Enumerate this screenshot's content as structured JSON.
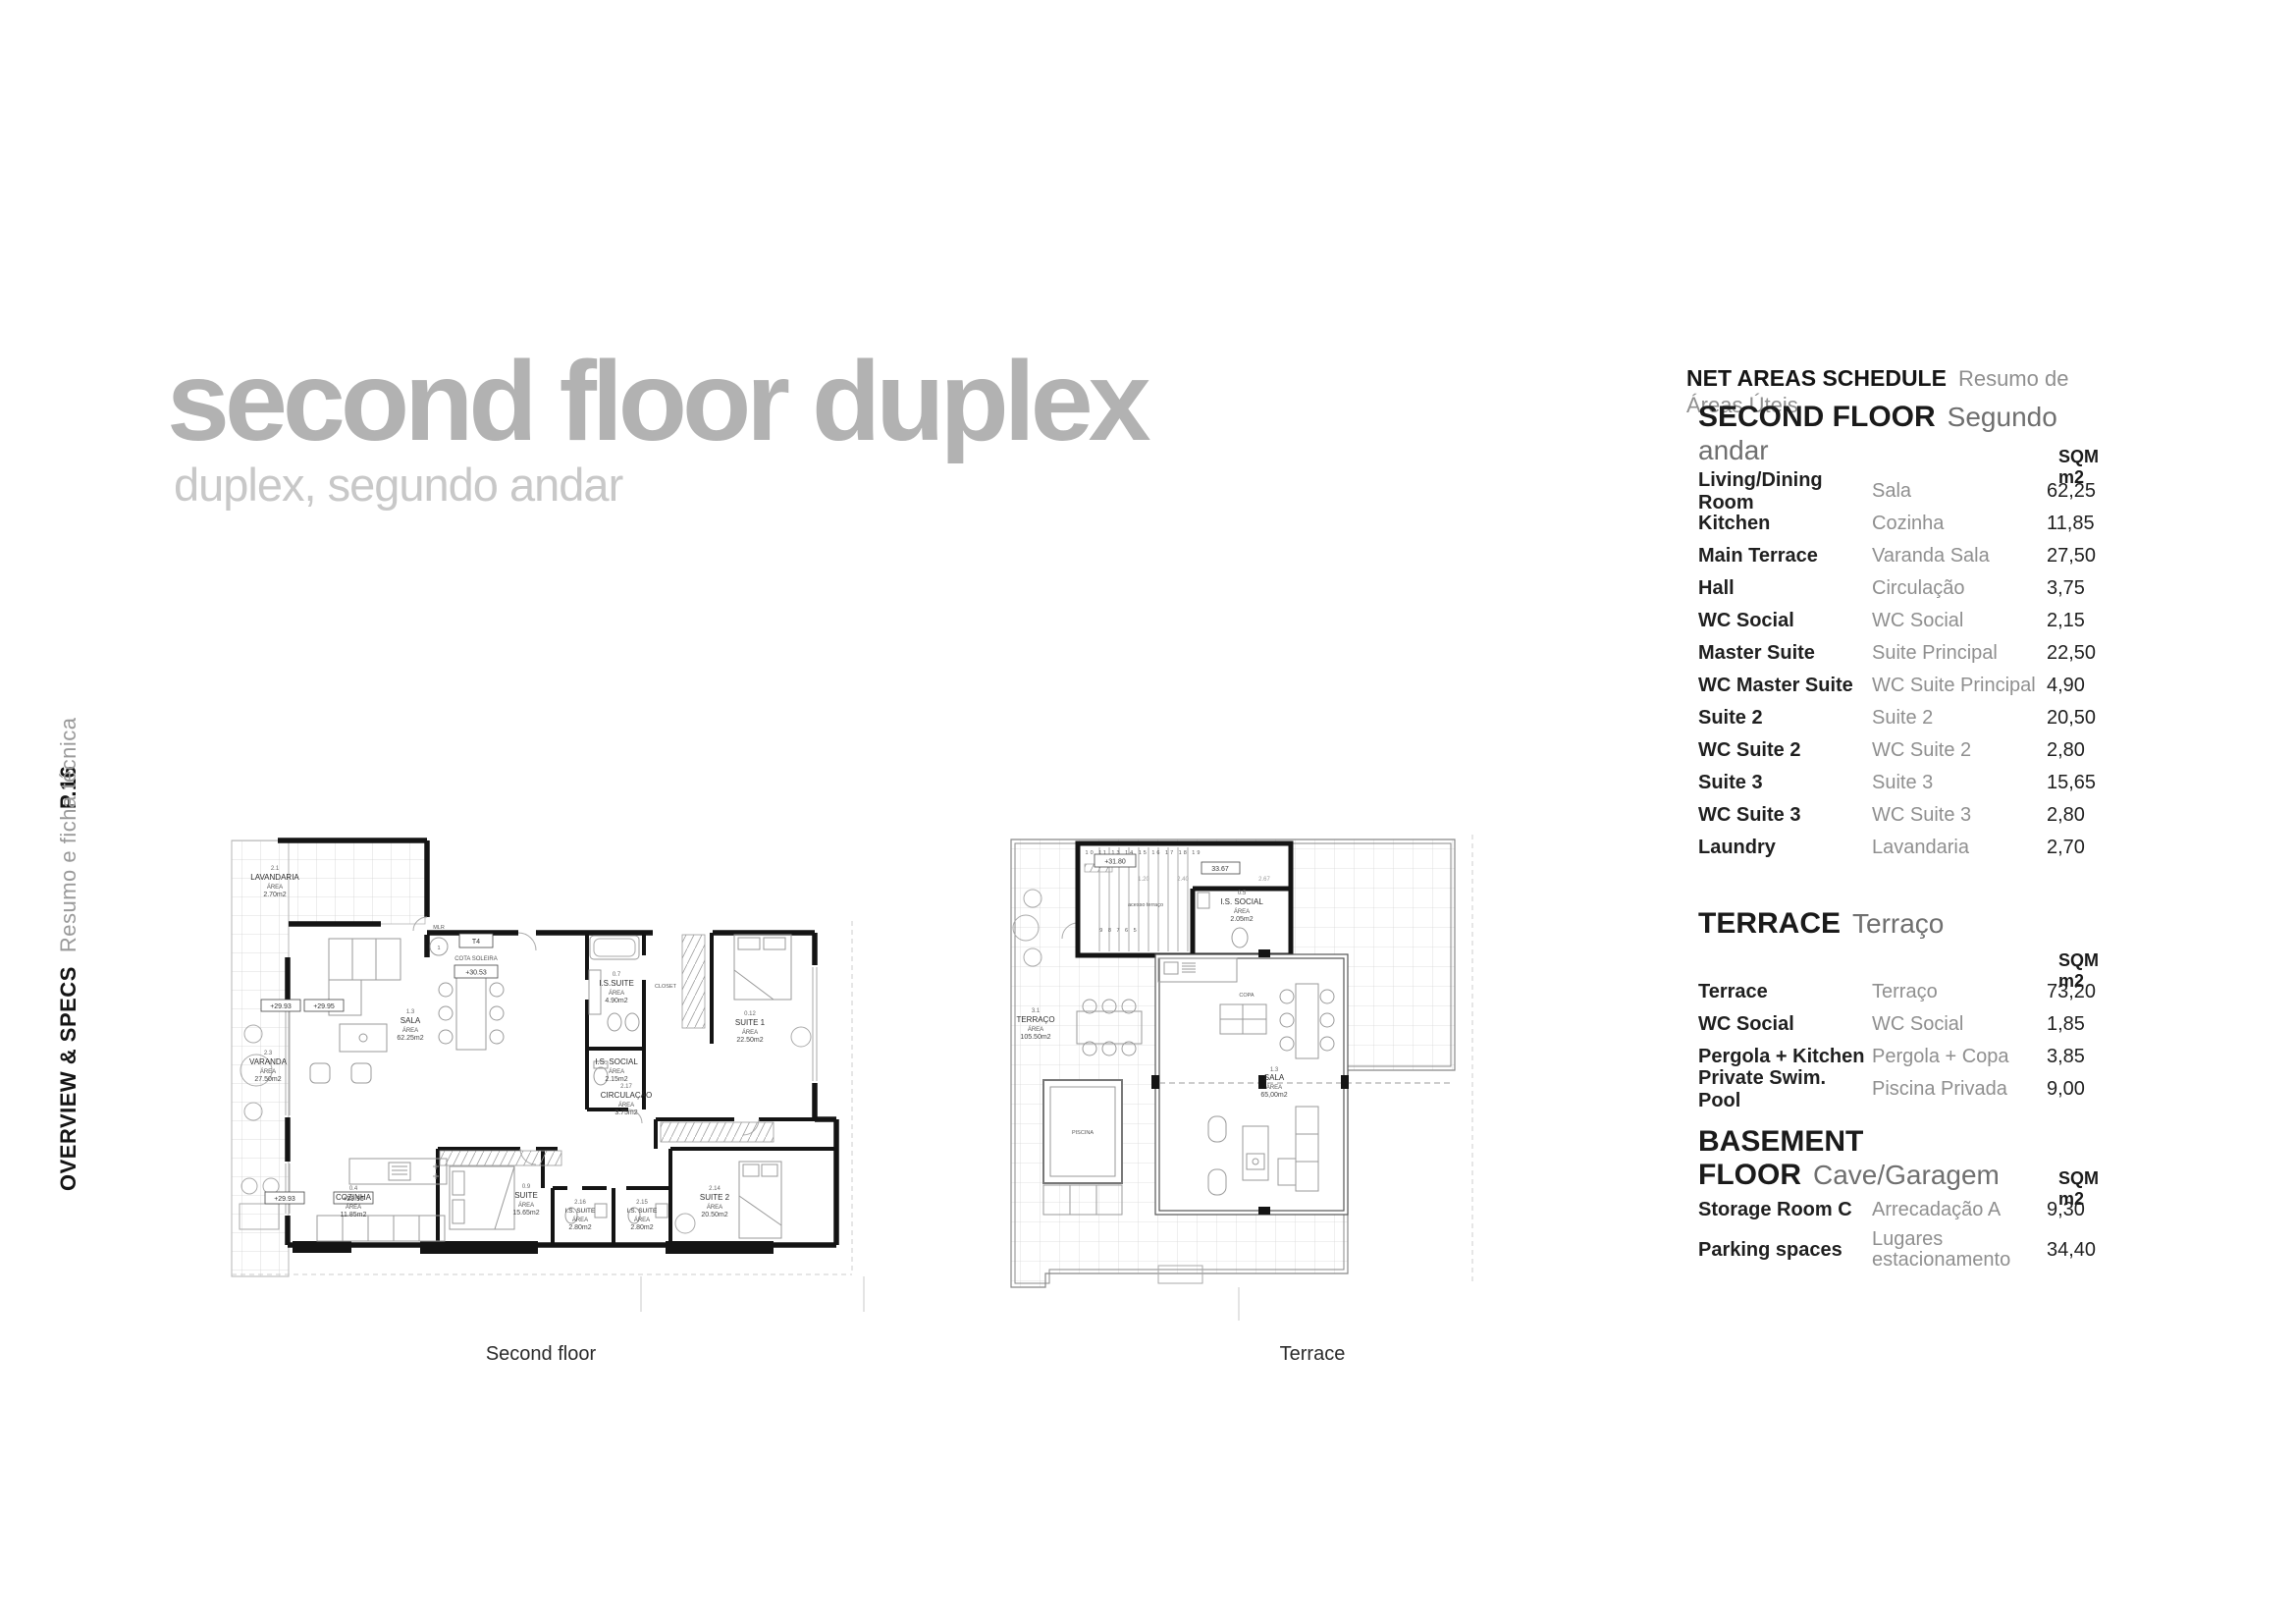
{
  "page": {
    "code": "P.16",
    "section": "OVERVIEW & SPECS",
    "section_sub": "Resumo e ficha técnica"
  },
  "title": {
    "main": "second floor duplex",
    "sub": "duplex, segundo andar"
  },
  "schedule": {
    "title": "NET AREAS SCHEDULE",
    "subtitle": "Resumo de Áreas Úteis",
    "unit": "SQM m2",
    "sections": [
      {
        "title": "SECOND FLOOR",
        "subtitle": "Segundo andar",
        "rows": [
          [
            "Living/Dining Room",
            "Sala",
            "62,25"
          ],
          [
            "Kitchen",
            "Cozinha",
            "11,85"
          ],
          [
            "Main Terrace",
            "Varanda Sala",
            "27,50"
          ],
          [
            "Hall",
            "Circulação",
            "3,75"
          ],
          [
            "WC Social",
            "WC Social",
            "2,15"
          ],
          [
            "Master Suite",
            "Suite Principal",
            "22,50"
          ],
          [
            "WC Master Suite",
            "WC Suite Principal",
            "4,90"
          ],
          [
            "Suite 2",
            "Suite 2",
            "20,50"
          ],
          [
            "WC Suite 2",
            "WC Suite 2",
            "2,80"
          ],
          [
            "Suite 3",
            "Suite 3",
            "15,65"
          ],
          [
            "WC Suite 3",
            "WC Suite 3",
            "2,80"
          ],
          [
            "Laundry",
            "Lavandaria",
            "2,70"
          ]
        ]
      },
      {
        "title": "TERRACE",
        "subtitle": "Terraço",
        "rows": [
          [
            "Terrace",
            "Terraço",
            "73,20"
          ],
          [
            "WC Social",
            "WC Social",
            "1,85"
          ],
          [
            "Pergola + Kitchen",
            "Pergola + Copa",
            "3,85"
          ],
          [
            "Private Swim. Pool",
            "Piscina Privada",
            "9,00"
          ]
        ]
      },
      {
        "title": "BASEMENT FLOOR",
        "subtitle": "Cave/Garagem",
        "rows": [
          [
            "Storage Room C",
            "Arrecadação A",
            "9,30"
          ],
          [
            "Parking spaces",
            "Lugares estacionamento",
            "34,40"
          ]
        ]
      }
    ]
  },
  "plans": {
    "area_label": "ÁREA",
    "second_floor": {
      "caption": "Second floor",
      "type_label": "T4",
      "cota_label": "COTA SOLEIRA",
      "cota_value": "+30.53",
      "level_a": "+29.93",
      "level_b": "+29.95",
      "mlr": "MLR",
      "stair_ref": "1",
      "rooms": [
        {
          "id": "2.1",
          "name": "LAVANDARIA",
          "area": "2.70m2"
        },
        {
          "id": "2.3",
          "name": "VARANDA",
          "area": "27.50m2"
        },
        {
          "id": "1.3",
          "name": "SALA",
          "area": "62.25m2"
        },
        {
          "id": "0.4",
          "name": "COZINHA",
          "area": "11.85m2"
        },
        {
          "id": "0.9",
          "name": "SUITE",
          "area": "15.65m2"
        },
        {
          "id": "0.7",
          "name": "I.S.SUITE",
          "area": "4.90m2"
        },
        {
          "id": "",
          "name": "CLOSET",
          "area": ""
        },
        {
          "id": "0.12",
          "name": "SUITE 1",
          "area": "22.50m2"
        },
        {
          "id": "",
          "name": "I.S. SOCIAL",
          "area": "2.15m2"
        },
        {
          "id": "2.17",
          "name": "CIRCULAÇÃO",
          "area": "3.75m2"
        },
        {
          "id": "2.16",
          "name": "I.S. SUITE",
          "area": "2.80m2"
        },
        {
          "id": "2.15",
          "name": "I.S. SUITE",
          "area": "2.80m2"
        },
        {
          "id": "2.14",
          "name": "SUITE 2",
          "area": "20.50m2"
        }
      ]
    },
    "terrace": {
      "caption": "Terrace",
      "level": "+31.80",
      "dim_boxed": "33.67",
      "dim_a": "1.20",
      "dim_b": "2.40",
      "dim_c": "2.67",
      "access_label": "acesso terraço",
      "stairs_top": "10 11 13 14 15 16 17 18 19",
      "stairs_bottom": "9 8 7 6 5",
      "rooms": [
        {
          "id": "3.1",
          "name": "TERRAÇO",
          "area": "105.50m2"
        },
        {
          "id": "0.5",
          "name": "I.S. SOCIAL",
          "area": "2.05m2"
        },
        {
          "id": "1.3",
          "name": "SALA",
          "area": "65,00m2"
        },
        {
          "id": "",
          "name": "COPA",
          "area": ""
        },
        {
          "id": "",
          "name": "PISCINA",
          "area": ""
        }
      ]
    }
  }
}
